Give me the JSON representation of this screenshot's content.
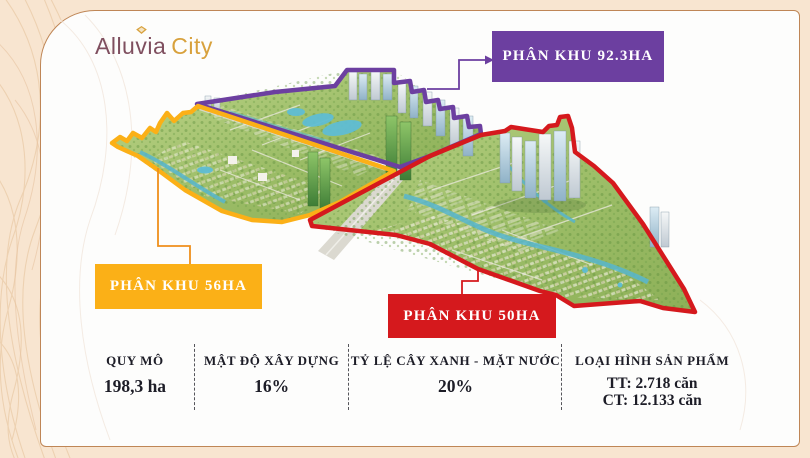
{
  "page": {
    "background_color": "#f8e5d0",
    "card_background": "#fdfdfc",
    "card_border_color": "#bf8656"
  },
  "logo": {
    "brand": "Alluvia",
    "suffix": "City",
    "brand_color": "#7f4f5f",
    "suffix_color": "#d8a13c"
  },
  "map": {
    "description": "Aerial 3D masterplan render divided into three outlined phases"
  },
  "zones": [
    {
      "label": "PHÂN KHU 92.3HA",
      "color": "#6c3fa0"
    },
    {
      "label": "PHÂN KHU 56HA",
      "color": "#fbb017"
    },
    {
      "label": "PHÂN KHU 50HA",
      "color": "#d5191d"
    }
  ],
  "stats": [
    {
      "label": "QUY MÔ",
      "value": "198,3 ha"
    },
    {
      "label": "MẬT ĐỘ XÂY DỰNG",
      "value": "16%"
    },
    {
      "label": "TỶ LỆ CÂY XANH - MẶT NƯỚC",
      "value": "20%"
    },
    {
      "label": "LOẠI HÌNH SẢN PHẨM",
      "values": [
        "TT: 2.718 căn",
        "CT: 12.133 căn"
      ]
    }
  ]
}
